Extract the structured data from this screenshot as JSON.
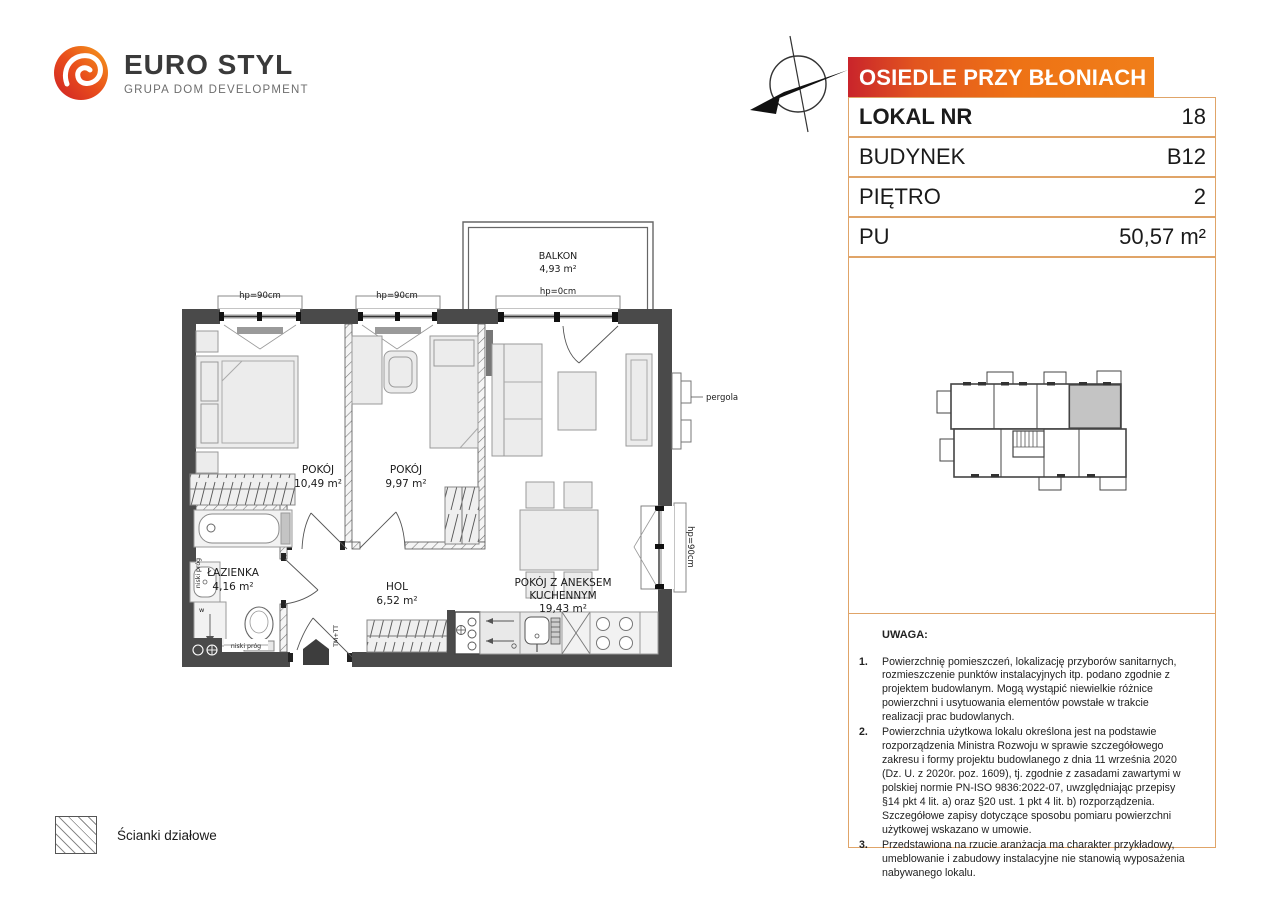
{
  "brand": {
    "name": "EURO STYL",
    "tagline": "GRUPA DOM DEVELOPMENT"
  },
  "estate_header": "OSIEDLE PRZY BŁONIACH",
  "info_table": {
    "rows": [
      {
        "label": "LOKAL NR",
        "value": "18"
      },
      {
        "label": "BUDYNEK",
        "value": "B12"
      },
      {
        "label": "PIĘTRO",
        "value": "2"
      },
      {
        "label": "PU",
        "value": "50,57 m²"
      }
    ]
  },
  "plan": {
    "rooms": {
      "balkon": {
        "name": "BALKON",
        "area": "4,93 m²"
      },
      "pokoj1": {
        "name": "POKÓJ",
        "area": "10,49 m²"
      },
      "pokoj2": {
        "name": "POKÓJ",
        "area": "9,97 m²"
      },
      "lazienka": {
        "name": "ŁAZIENKA",
        "area": "4,16 m²"
      },
      "hol": {
        "name": "HOL",
        "area": "6,52 m²"
      },
      "salon": {
        "name_line1": "POKÓJ Z ANEKSEM",
        "name_line2": "KUCHENNYM",
        "area": "19,43 m²"
      }
    },
    "annotations": {
      "window_left": "hp=90cm",
      "window_mid": "hp=90cm",
      "balcony_door": "hp=0cm",
      "window_right": "hp=90cm",
      "pergola": "pergola",
      "low_threshold_1": "niski próg",
      "low_threshold_2": "niski próg",
      "tm_tt": "TM+TT",
      "washer": "w"
    }
  },
  "legend": {
    "label": "Ścianki działowe"
  },
  "notes": {
    "title": "UWAGA:",
    "items": [
      "Powierzchnię pomieszczeń, lokalizację przyborów sanitarnych, rozmieszczenie punktów instalacyjnych itp. podano zgodnie z projektem budowlanym. Mogą wystąpić niewielkie różnice powierzchni i usytuowania elementów powstałe w trakcie realizacji prac budowlanych.",
      "Powierzchnia użytkowa lokalu określona jest na podstawie rozporządzenia Ministra Rozwoju w sprawie szczegółowego zakresu i formy projektu budowlanego z dnia 11 września 2020 (Dz. U. z 2020r. poz. 1609), tj. zgodnie z zasadami zawartymi w polskiej normie PN-ISO 9836:2022-07, uwzględniając przepisy §14 pkt 4 lit. a) oraz §20 ust. 1 pkt 4 lit. b) rozporządzenia. Szczegółowe zapisy dotyczące sposobu pomiaru powierzchni użytkowej wskazano w umowie.",
      "Przedstawiona na rzucie aranżacja ma charakter przykładowy, umeblowanie i zabudowy instalacyjne nie stanowią wyposażenia nabywanego lokalu."
    ]
  },
  "colors": {
    "accent_red": "#c9242b",
    "accent_orange": "#ee7215",
    "border_tan": "#e0a468",
    "wall_dark": "#4a4a4a",
    "unit_highlight": "#c4c4c4"
  }
}
